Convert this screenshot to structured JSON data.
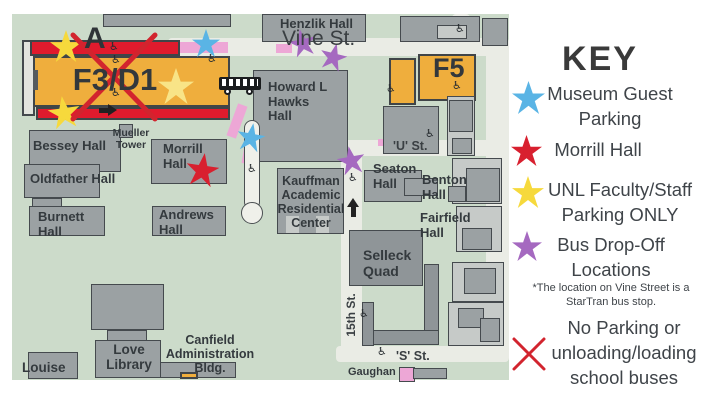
{
  "map": {
    "zone_label": "A",
    "lots": {
      "f3d1": "F3/D1",
      "f5": "F5"
    },
    "streets": {
      "vine": "Vine St.",
      "u": "'U' St.",
      "s": "'S' St.",
      "fifteenth": "15th St."
    },
    "buildings": {
      "henzlik": "Henzlik Hall",
      "howard_hawks": "Howard L Hawks Hall",
      "bessey": "Bessey Hall",
      "mueller": "Mueller Tower",
      "morrill": "Morrill Hall",
      "oldfather": "Oldfather Hall",
      "burnett": "Burnett Hall",
      "andrews": "Andrews Hall",
      "kauffman": "Kauffman Academic Residential Center",
      "seaton": "Seaton Hall",
      "benton": "Benton Hall",
      "fairfield": "Fairfield Hall",
      "selleck": "Selleck Quad",
      "love_library": "Love Library",
      "louise": "Louise",
      "canfield": "Canfield Administration Bldg.",
      "gaughan": "Gaughan"
    }
  },
  "key": {
    "title": "KEY",
    "items": {
      "museum": {
        "label": "Museum Guest Parking",
        "icon": "blue-star"
      },
      "morrill": {
        "label": "Morrill Hall",
        "icon": "red-star"
      },
      "faculty": {
        "label": "UNL Faculty/Staff Parking ONLY",
        "icon": "yellow-star"
      },
      "bus": {
        "label": "Bus Drop-Off Locations",
        "icon": "purple-star",
        "note": "*The location on Vine Street is a StarTran bus stop."
      },
      "no_parking": {
        "label": "No Parking or unloading/loading school buses",
        "icon": "red-x"
      }
    }
  },
  "colors": {
    "map_bg": "#ccdbca",
    "road": "#eaece5",
    "building": "#9ba1a3",
    "building_light": "#c6cac8",
    "lot_orange": "#efae3d",
    "restricted_red": "#e01b2d",
    "star_yellow": "#f6d93c",
    "star_yellow_pale": "#f8e487",
    "star_blue": "#5ab4e5",
    "star_red": "#d8202f",
    "star_purple": "#a569c0",
    "path_pink": "#eda7d6",
    "no_parking_x": "#d2242e"
  }
}
